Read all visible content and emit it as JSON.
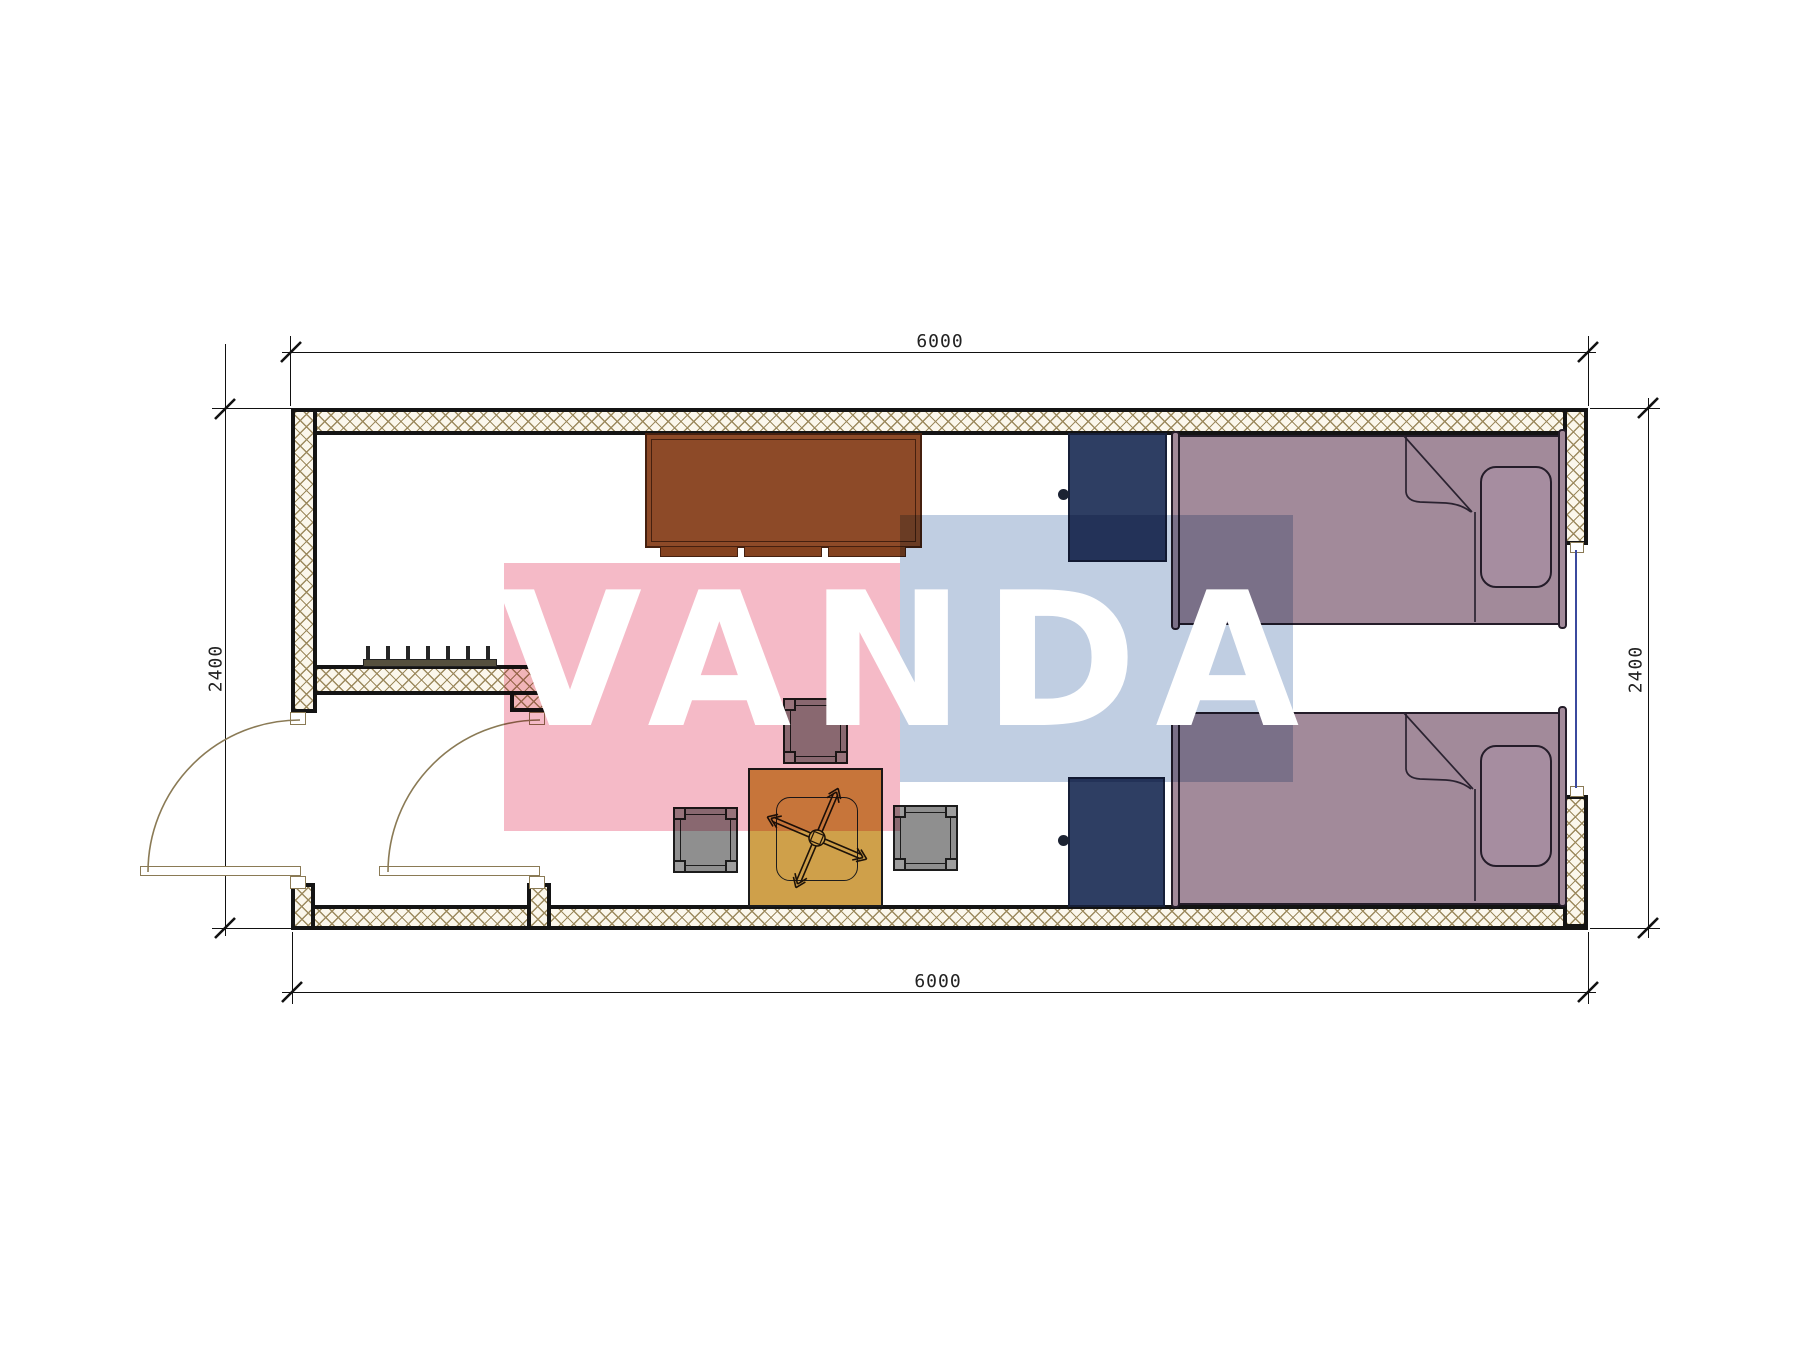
{
  "title": "container-room-floor-plan",
  "dimensions": {
    "top": "6000",
    "bottom": "6000",
    "left": "2400",
    "right": "2400"
  },
  "watermark": {
    "text": "VANDA",
    "pink_color": "#f5bac7",
    "blue_color": "#c0cee2",
    "text_color": "#ffffff"
  },
  "colors": {
    "wall_hatch": "#9c8a5e",
    "wall_fill": "#fbf7ec",
    "outline": "#141414",
    "desk": "#8d4a28",
    "desk_trim": "#45200f",
    "bed": "#a28a9a",
    "bed_outline": "#241c29",
    "cabinet": "#2e3e63",
    "stool": "#8f8f8f",
    "table": "#cfa04a",
    "door_line": "#8a7a55",
    "window_glass": "#3b4a9e",
    "radiator": "#55503e",
    "dimension_line": "#111111"
  },
  "furniture": [
    "desk",
    "desk-drawer-strips",
    "cabinet-top",
    "cabinet-bottom",
    "bed-top",
    "bed-bottom",
    "pillow-top",
    "pillow-bottom",
    "tea-table",
    "office-chair",
    "stool-top",
    "stool-left",
    "stool-right",
    "radiator",
    "entry-door",
    "inner-door",
    "window"
  ]
}
